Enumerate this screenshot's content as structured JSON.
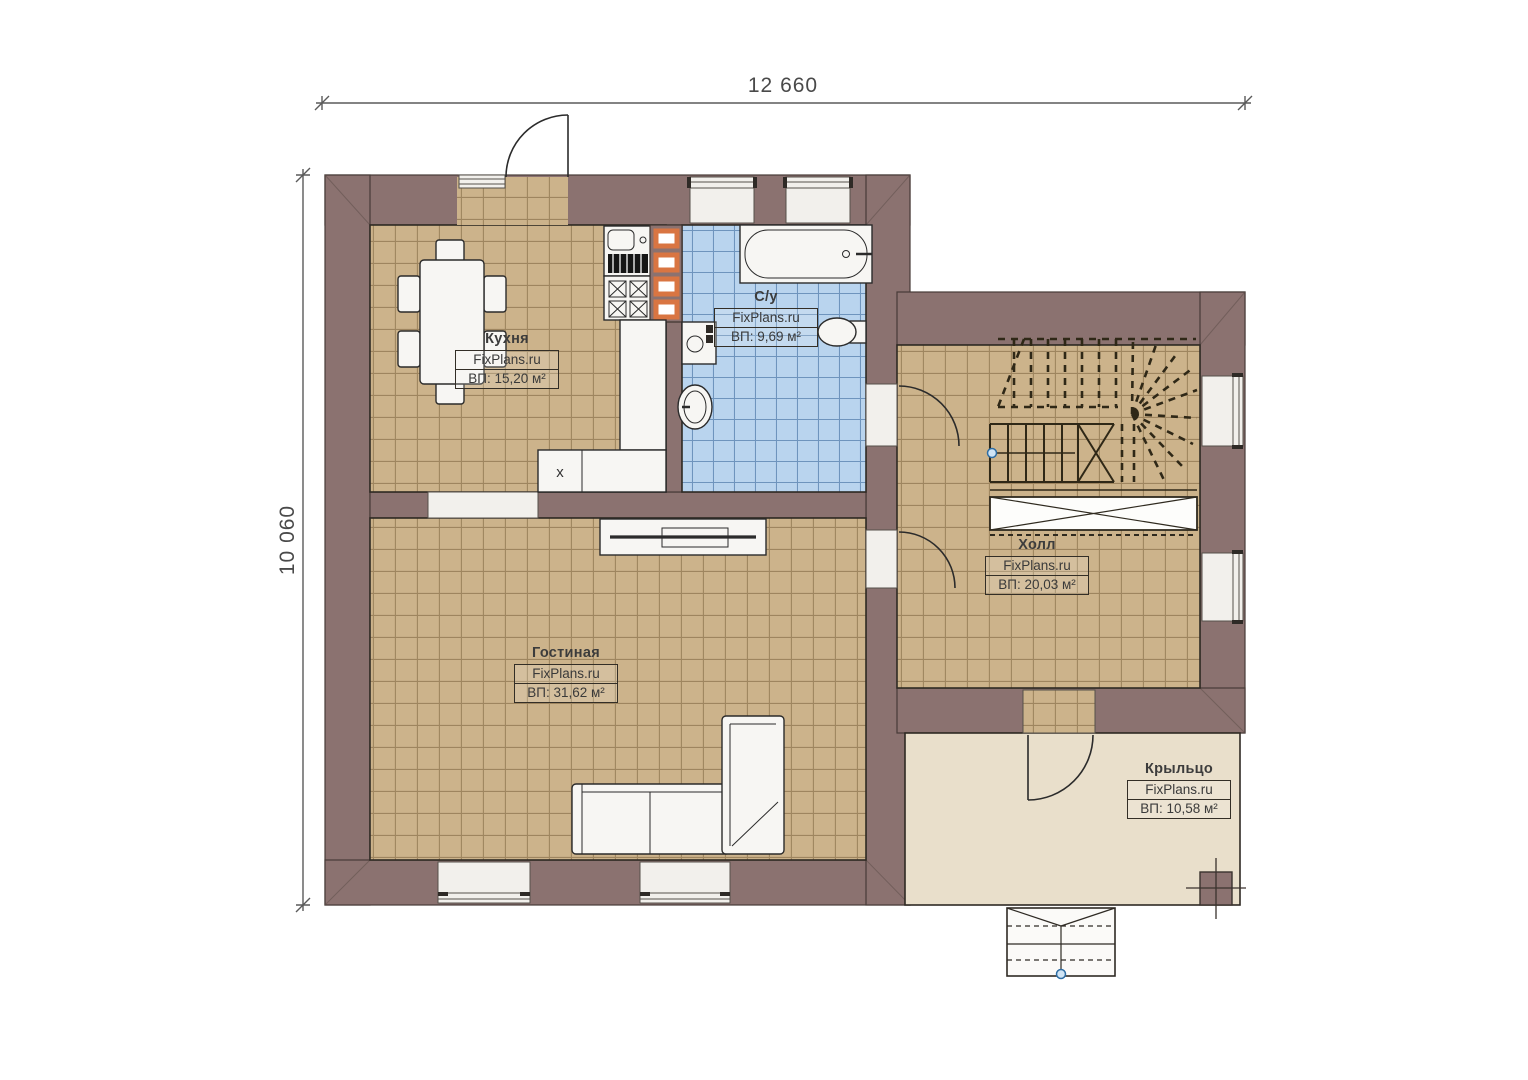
{
  "plan": {
    "dimensions": {
      "width_label": "12 660",
      "height_label": "10 060"
    },
    "rooms": [
      {
        "name": "Кухня",
        "watermark": "FixPlans.ru",
        "area": "ВП: 15,20 м²"
      },
      {
        "name": "С/у",
        "watermark": "FixPlans.ru",
        "area": "ВП: 9,69 м²"
      },
      {
        "name": "Холл",
        "watermark": "FixPlans.ru",
        "area": "ВП: 20,03 м²"
      },
      {
        "name": "Гостиная",
        "watermark": "FixPlans.ru",
        "area": "ВП: 31,62 м²"
      },
      {
        "name": "Крыльцо",
        "watermark": "FixPlans.ru",
        "area": "ВП: 10,58 м²"
      }
    ],
    "annotations": {
      "kitchen_appliance_mark": "x"
    },
    "colors": {
      "wall": "#8b7270",
      "floor_tile": "#ccb38b",
      "bathroom_tile": "#b9d4ee",
      "porch_floor": "#e9dfcb",
      "accent_orange": "#d97542",
      "label_text": "#3a3a3a",
      "dimension_text": "#4a4a4a"
    }
  }
}
